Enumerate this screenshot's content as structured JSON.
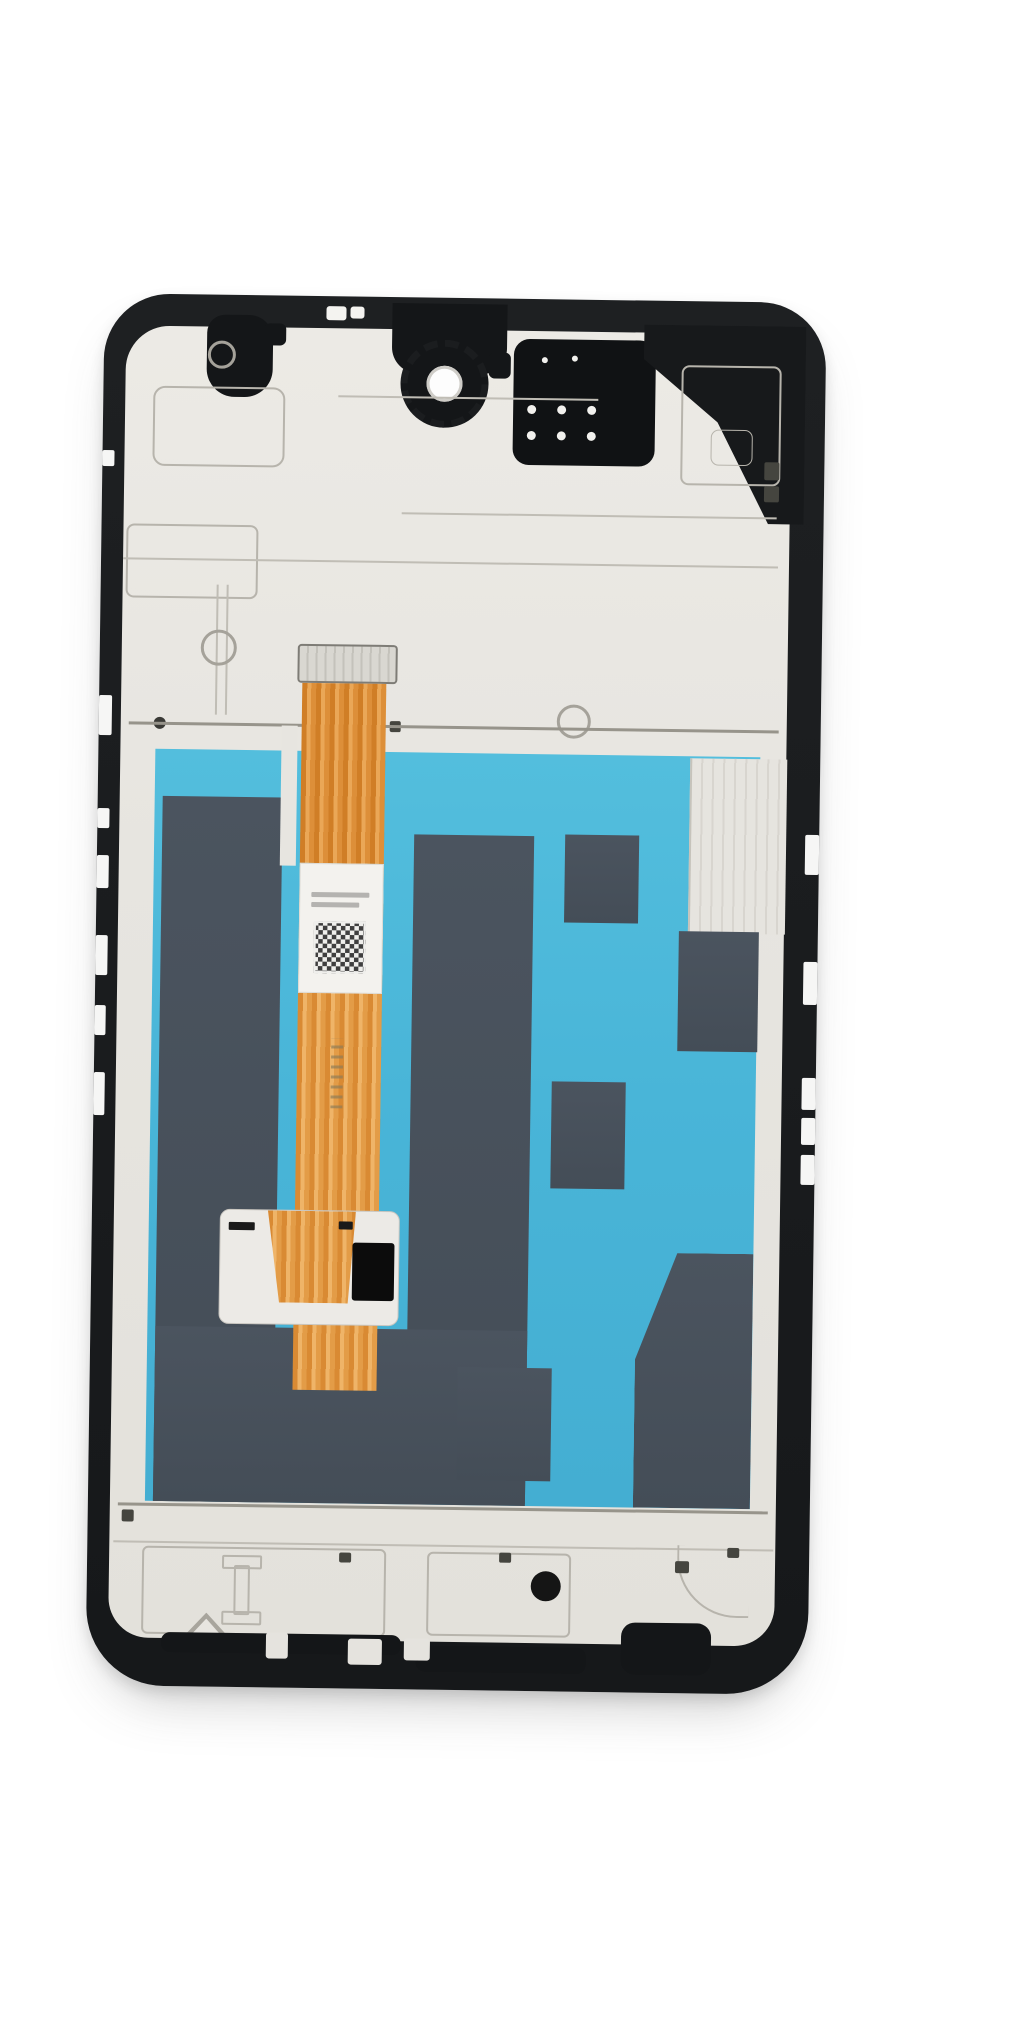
{
  "scene": {
    "type": "product-photo",
    "subject": "Smartphone LCD screen and digitizer assembly with middle frame, rear view, on white background",
    "background_color": "#ffffff"
  },
  "colors": {
    "frame_black": "#1b1d1f",
    "plate_gray": "#e7e5e0",
    "etch_gray": "#b7b4ac",
    "film_teal": "#49b5d8",
    "panel_slate": "#4a535e",
    "flex_orange": "#e8a34e",
    "flex_stripe": "#d98a33",
    "label_white": "#f3f2ee",
    "qr_dark": "#3f3f3f",
    "chip_black": "#0c0c0c",
    "speaker_black": "#101214",
    "camera_hole_white": "#fdfdfd"
  },
  "parts": {
    "frame": "middle frame (black)",
    "plate": "metal back plate (pale gray)",
    "camera": "rear camera opening with scalloped retainer ring",
    "speaker": "earpiece / speaker mesh block with contact dots",
    "front_cam_cutout": "front camera cutout",
    "film": "teal protective film over display back",
    "slate_panels": "graphite shielding panels",
    "flex": "orange LCD flex ribbon cable",
    "flex_connector": "flex connector tab",
    "flex_label": "white service label with QR code",
    "driver_pad": "white driver IC pad with black chip",
    "edge_notches": "antenna line cutouts on frame edges",
    "screw_holes": "screw holes and bosses"
  }
}
